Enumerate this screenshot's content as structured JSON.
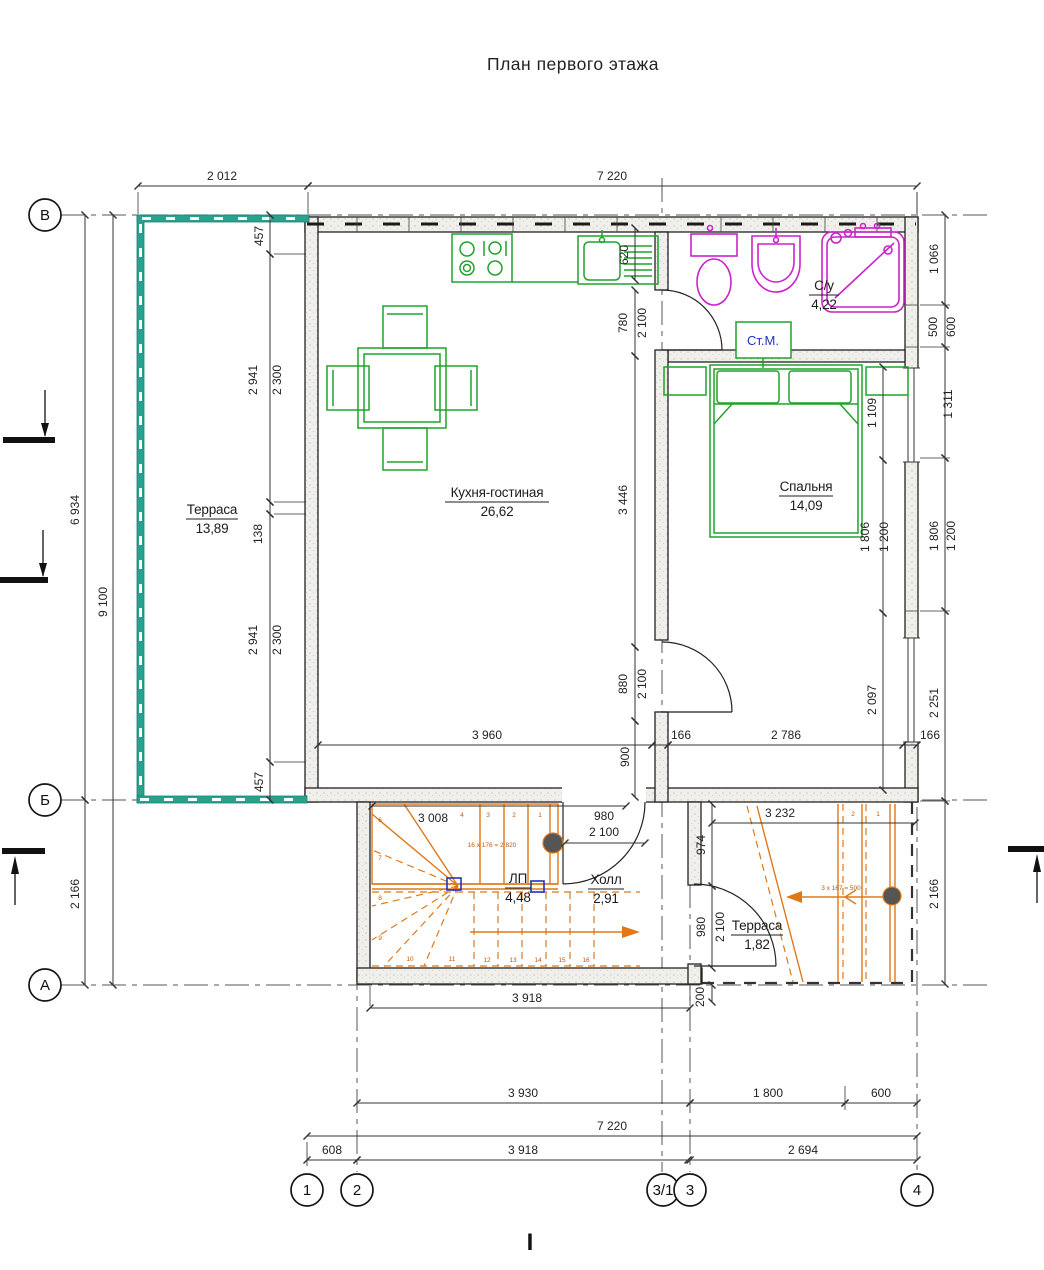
{
  "title": "План первого этажа",
  "axes": {
    "rows": [
      "В",
      "Б",
      "А"
    ],
    "cols": [
      "1",
      "2",
      "3/1",
      "3",
      "4"
    ]
  },
  "rooms": {
    "terrace": {
      "name": "Терраса",
      "area": "13,89"
    },
    "kitchen_living": {
      "name": "Кухня-гостиная",
      "area": "26,62"
    },
    "bedroom": {
      "name": "Спальня",
      "area": "14,09"
    },
    "bathroom": {
      "name": "С/у",
      "area": "4,22"
    },
    "stair_landing": {
      "name": "ЛП",
      "area": "4,48"
    },
    "hall": {
      "name": "Холл",
      "area": "2,91"
    },
    "terrace_south": {
      "name": "Терраса",
      "area": "1,82"
    }
  },
  "labels": {
    "washing_machine": "Ст.М.",
    "stairs_note": "16 х 176 = 2 820",
    "ramp_note": "3 х 167 = 500",
    "section_mark": "I"
  },
  "dims": {
    "top": [
      "2 012",
      "7 220"
    ],
    "left": [
      "6 934",
      "9 100",
      "2 166"
    ],
    "terrace_chain": [
      "457",
      "2 941",
      "2 300",
      "138",
      "2 941",
      "2 300",
      "457"
    ],
    "kitchen": [
      "620",
      "3 960"
    ],
    "mid_chain": [
      "780",
      "2 100",
      "3 446",
      "880",
      "2 100",
      "900"
    ],
    "width_row": [
      "166",
      "2 786",
      "166"
    ],
    "right_inner": [
      "1 109",
      "1 806",
      "1 200",
      "2 097"
    ],
    "right_outer": [
      "1 066",
      "500",
      "600",
      "1 311",
      "1 806",
      "1 200",
      "2 251",
      "2 166"
    ],
    "stairs": [
      "3 008",
      "980",
      "2 100",
      "3 918"
    ],
    "terrace_south": [
      "3 232",
      "974",
      "980",
      "2 100",
      "200"
    ],
    "bottom": [
      "3 930",
      "1 800",
      "600",
      "7 220",
      "608",
      "3 918",
      "2 694"
    ]
  },
  "stair_treads": [
    "1",
    "2",
    "3",
    "4",
    "6",
    "7",
    "8",
    "9",
    "10",
    "11",
    "12",
    "13",
    "14",
    "15",
    "16"
  ],
  "ramp_treads": [
    "1",
    "2"
  ],
  "colors": {
    "walls": "#222222",
    "furniture": "#1fa32a",
    "plumbing": "#cc22cc",
    "terrace_wall": "#2aa18f",
    "stairs": "#e07818",
    "dims": "#333333",
    "washing_machine_text": "#2233bb",
    "column": "#555555"
  }
}
